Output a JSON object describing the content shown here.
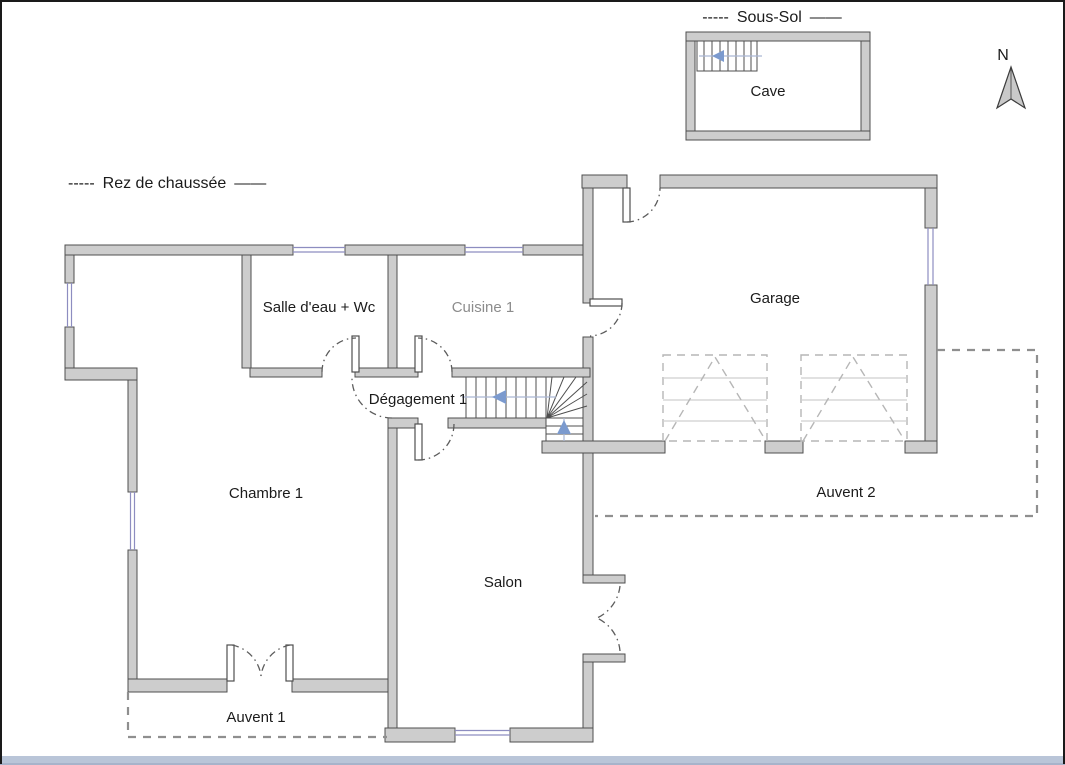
{
  "floors": {
    "sous_sol": {
      "dashes_left": "-----",
      "title": "Sous-Sol",
      "dashes_right": "——"
    },
    "rez": {
      "dashes_left": "-----",
      "title": "Rez de chaussée",
      "dashes_right": "——"
    }
  },
  "compass": {
    "label": "N"
  },
  "rooms": {
    "cave": "Cave",
    "salle_eau": "Salle d'eau + Wc",
    "cuisine": "Cuisine 1",
    "garage": "Garage",
    "degagement": "Dégagement 1",
    "chambre": "Chambre 1",
    "salon": "Salon",
    "auvent1": "Auvent 1",
    "auvent2": "Auvent 2"
  },
  "colors": {
    "wall_fill": "#cdcdcd",
    "wall_stroke": "#4f4f4f",
    "window_glass_line": "#8d8dc0",
    "stair_direction_arrow": "#7b9ace",
    "awning_dashed": "#8f8f8f",
    "garage_door_dashed": "#b6b6b6",
    "door_arc": "#5c5c5c",
    "label_text": "#1b1b1b",
    "label_text_muted": "#8c8c8c",
    "bottom_strip": "#b9c5d8"
  }
}
